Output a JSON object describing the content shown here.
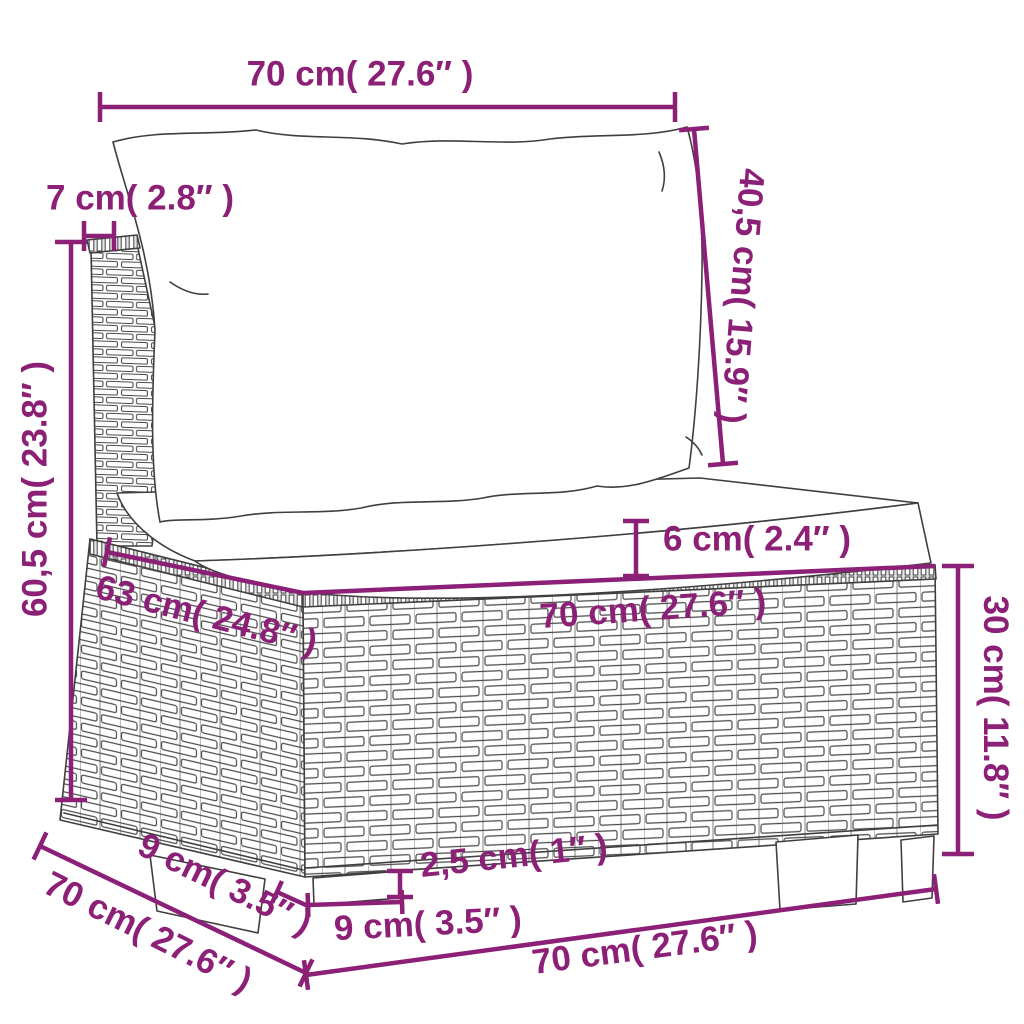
{
  "diagram": {
    "type": "product-dimension-diagram",
    "subject": "rattan-sofa-middle-section-with-cushions",
    "background_color": "#ffffff",
    "accent_color": "#8c2077",
    "line_color": "#3f3f3f",
    "units": [
      "cm",
      "inch"
    ],
    "label_font_size": 35,
    "dimensions": [
      {
        "id": "back-cushion-width",
        "line": [
          100,
          107,
          675,
          107
        ],
        "ticks": "both",
        "tick_len": 30,
        "labels": [
          {
            "t": "70 cm( 27.6″ )",
            "x": 360,
            "y": 76,
            "r": 0
          }
        ]
      },
      {
        "id": "back-cushion-height",
        "line": [
          694,
          129,
          723,
          464
        ],
        "ticks": "both",
        "tick_len": 30,
        "labels": [
          {
            "t": "40,5 cm( 15.9″ )",
            "x": 740,
            "y": 296,
            "r": 94.5
          }
        ]
      },
      {
        "id": "back-panel-depth",
        "line": [
          84,
          236,
          114,
          236
        ],
        "ticks": "both",
        "tick_len": 30,
        "labels": [
          {
            "t": "7 cm( 2.8″ )",
            "x": 140,
            "y": 200,
            "r": 0
          }
        ]
      },
      {
        "id": "total-height",
        "line": [
          71,
          242,
          71,
          800
        ],
        "ticks": "both",
        "tick_len": 32,
        "labels": [
          {
            "t": "60,5 cm( 23.8″ )",
            "x": 37,
            "y": 489,
            "r": -90
          }
        ]
      },
      {
        "id": "seat-cushion-thickness",
        "line": [
          636,
          521,
          636,
          576
        ],
        "ticks": "both",
        "tick_len": 26,
        "labels": [
          {
            "t": "6 cm( 2.4″ )",
            "x": 757,
            "y": 541,
            "r": 0
          }
        ]
      },
      {
        "id": "seat-depth",
        "line": [
          107,
          552,
          303,
          593
        ],
        "ticks": "start",
        "tick_len": 30,
        "labels": [
          {
            "t": "63 cm( 24.8″ )",
            "x": 206,
            "y": 617,
            "r": 14.5
          }
        ]
      },
      {
        "id": "seat-width",
        "line": [
          303,
          593,
          935,
          566
        ],
        "ticks": "none",
        "tick_len": 26,
        "labels": [
          {
            "t": "70 cm( 27.6″ )",
            "x": 653,
            "y": 611,
            "r": -4
          }
        ]
      },
      {
        "id": "base-height",
        "line": [
          958,
          566,
          958,
          854
        ],
        "ticks": "both",
        "tick_len": 32,
        "labels": [
          {
            "t": "30 cm( 11.8″ )",
            "x": 993,
            "y": 708,
            "r": 90
          }
        ]
      },
      {
        "id": "base-depth-bottom",
        "line": [
          40,
          846,
          306,
          973
        ],
        "ticks": "both",
        "tick_len": 30,
        "labels": [
          {
            "t": "9 cm( 3.5″ )",
            "x": 224,
            "y": 886,
            "r": 26
          },
          {
            "t": "70 cm( 27.6″ )",
            "x": 147,
            "y": 934,
            "r": 26.5
          }
        ]
      },
      {
        "id": "foot-inset",
        "line": [
          277,
          892,
          308,
          906
        ],
        "ticks": "start",
        "tick_len": 24,
        "labels": []
      },
      {
        "id": "foot-width",
        "line": [
          308,
          905,
          402,
          902
        ],
        "ticks": "both",
        "tick_len": 24,
        "labels": [
          {
            "t": "9 cm( 3.5″ )",
            "x": 428,
            "y": 926,
            "r": -3
          }
        ]
      },
      {
        "id": "foot-height",
        "line": [
          400,
          871,
          400,
          897
        ],
        "ticks": "both",
        "tick_len": 26,
        "labels": [
          {
            "t": "2,5 cm( 1″ )",
            "x": 514,
            "y": 858,
            "r": -6
          }
        ]
      },
      {
        "id": "base-width-bottom",
        "line": [
          306,
          975,
          936,
          889
        ],
        "ticks": "both",
        "tick_len": 30,
        "labels": [
          {
            "t": "70 cm( 27.6″ )",
            "x": 645,
            "y": 950,
            "r": -7.5
          }
        ]
      }
    ]
  }
}
